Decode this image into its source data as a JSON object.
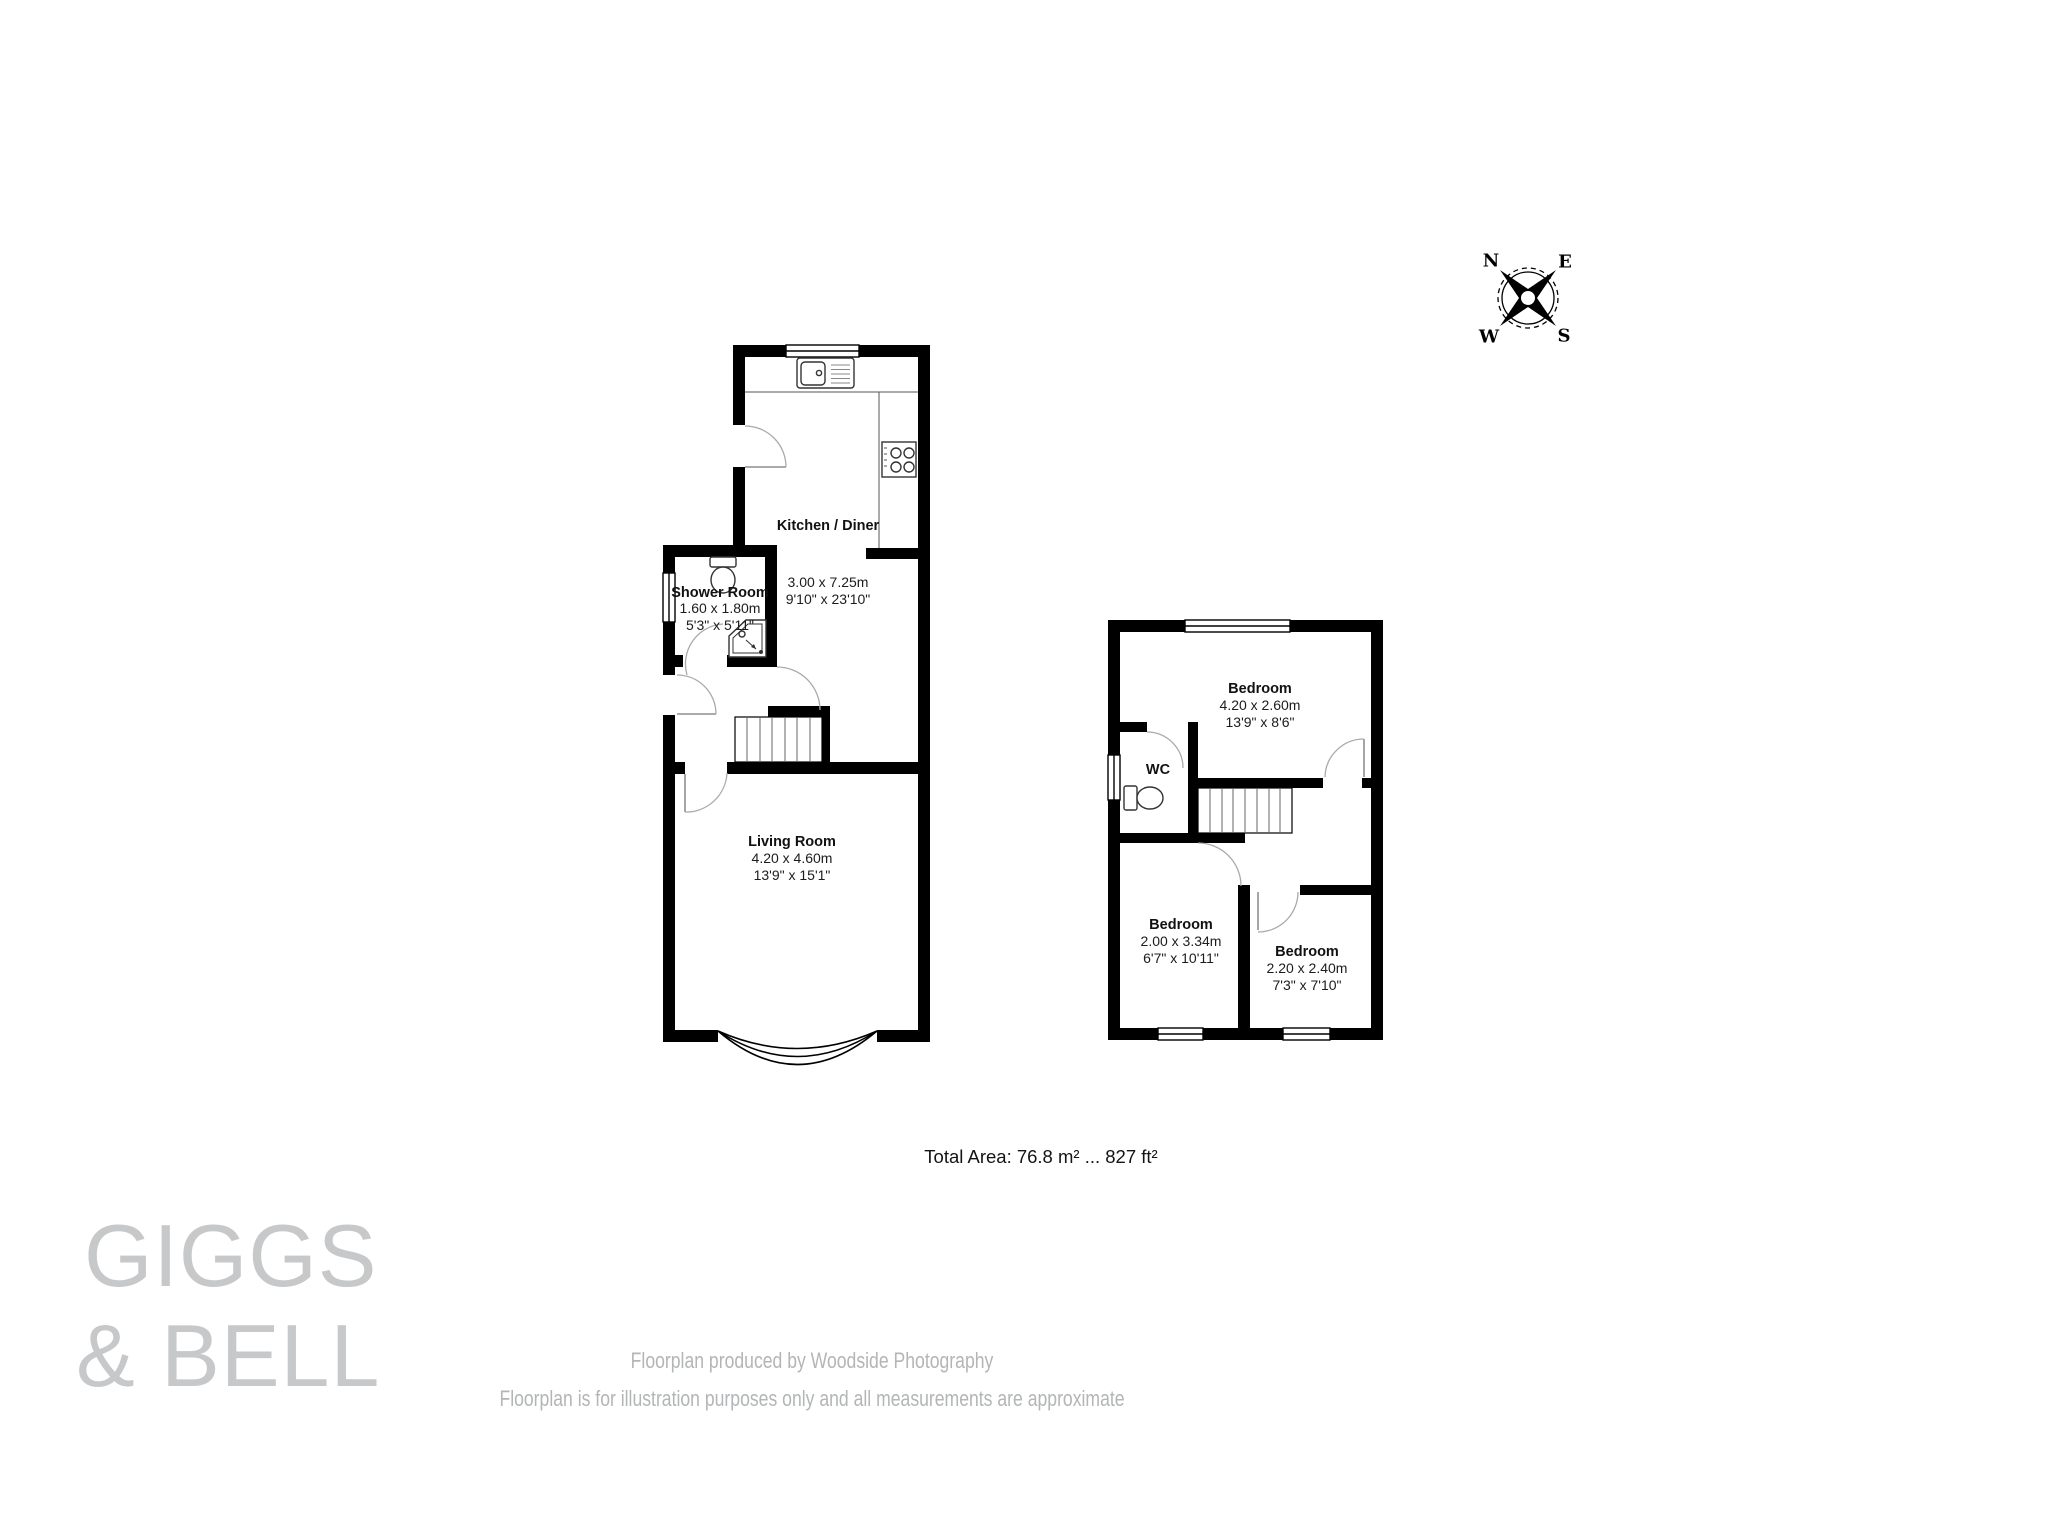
{
  "compass": {
    "n": "N",
    "e": "E",
    "s": "S",
    "w": "W"
  },
  "ground_floor": {
    "kitchen": {
      "name": "Kitchen / Diner",
      "dims_m": "3.00 x 7.25m",
      "dims_ft": "9'10\" x 23'10\""
    },
    "shower": {
      "name": "Shower Room",
      "dims_m": "1.60 x 1.80m",
      "dims_ft": "5'3\" x 5'11\""
    },
    "living": {
      "name": "Living Room",
      "dims_m": "4.20 x 4.60m",
      "dims_ft": "13'9\" x 15'1\""
    }
  },
  "first_floor": {
    "wc": {
      "name": "WC"
    },
    "bedroom1": {
      "name": "Bedroom",
      "dims_m": "4.20 x 2.60m",
      "dims_ft": "13'9\" x 8'6\""
    },
    "bedroom2": {
      "name": "Bedroom",
      "dims_m": "2.00 x 3.34m",
      "dims_ft": "6'7\" x 10'11\""
    },
    "bedroom3": {
      "name": "Bedroom",
      "dims_m": "2.20 x 2.40m",
      "dims_ft": "7'3\" x 7'10\""
    }
  },
  "total_area": "Total Area: 76.8 m² ... 827 ft²",
  "logo": {
    "line1": "GIGGS",
    "line2": "& BELL"
  },
  "footer": {
    "line1": "Floorplan produced by Woodside Photography",
    "line2": "Floorplan is for illustration purposes only and all measurements are approximate"
  },
  "colors": {
    "wall": "#000000",
    "door_arc": "#aaaaaa",
    "footer_gray": "#b3b5b6",
    "logo_gray": "#c6c8c9"
  }
}
